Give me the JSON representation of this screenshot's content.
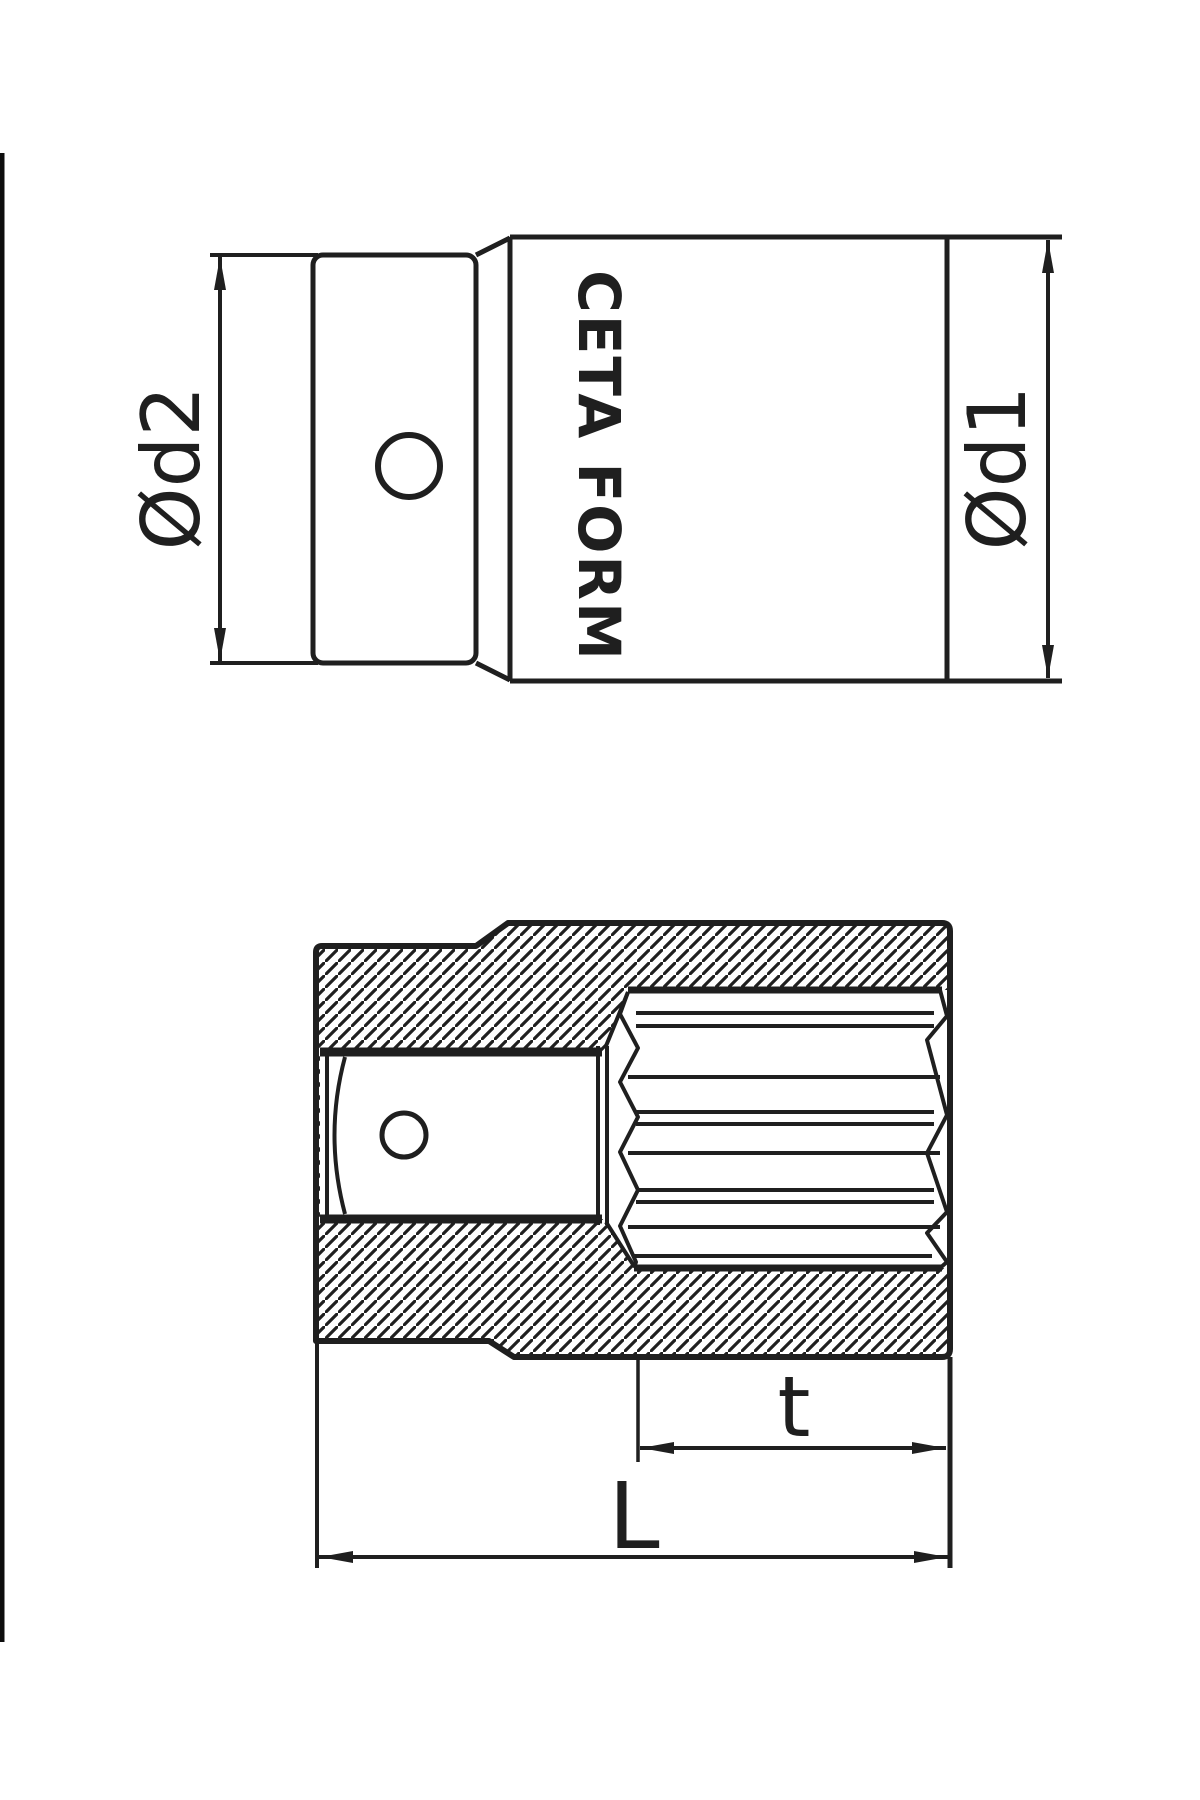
{
  "drawing": {
    "brand": "CETA FORM",
    "labels": {
      "d2": "Ød2",
      "d1": "Ød1",
      "t": "t",
      "L": "L"
    },
    "colors": {
      "line": "#1f1f1f",
      "background": "#ffffff",
      "artifact_bar": "#0d0d0d"
    },
    "views": {
      "side_view": "socket side elevation with drive end, pin hole and brand marking",
      "section_view": "hatched longitudinal cross-section with square drive cavity and 12-point socket profile"
    }
  }
}
